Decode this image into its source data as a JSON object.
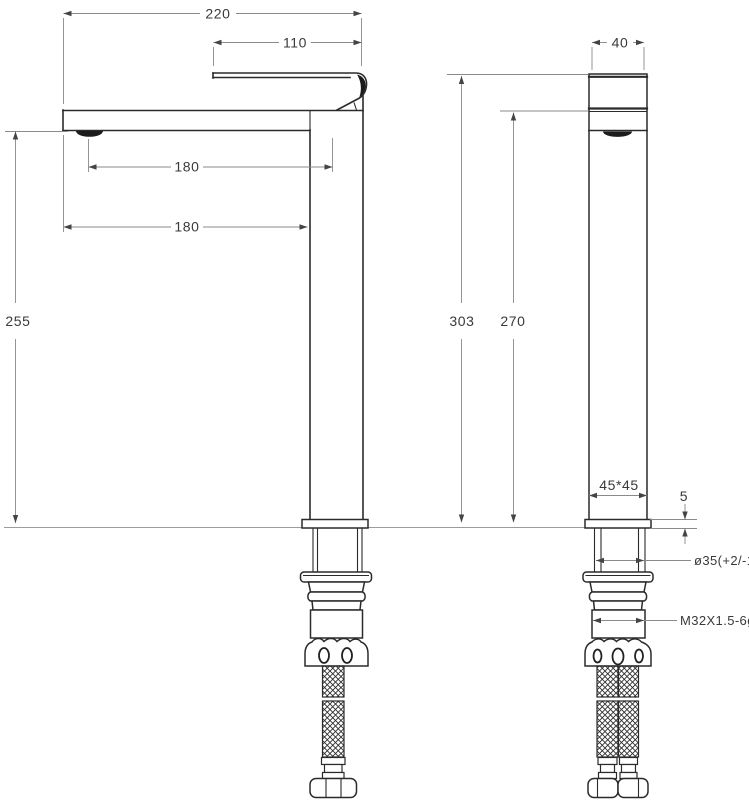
{
  "drawing": {
    "type": "faucet-installation-dimension-drawing",
    "views": [
      "side-view",
      "front-view"
    ],
    "labels": {
      "overall_width": "220",
      "handle_length": "110",
      "aerator_offset": "180",
      "spout_reach": "180",
      "spout_height": "255",
      "overall_height": "303",
      "body_height": "270",
      "body_width": "40",
      "base_section": "45*45",
      "plate_thickness": "5",
      "mounting_hole_diameter": "ø35(+2/-1)",
      "thread_spec": "M32X1.5-6g"
    },
    "colors": {
      "object_line": "#2b2b2b",
      "dimension_line": "#8a8a8a",
      "text": "#3a3a3a",
      "dark_fill": "#1c1c1c",
      "background": "#ffffff"
    }
  }
}
